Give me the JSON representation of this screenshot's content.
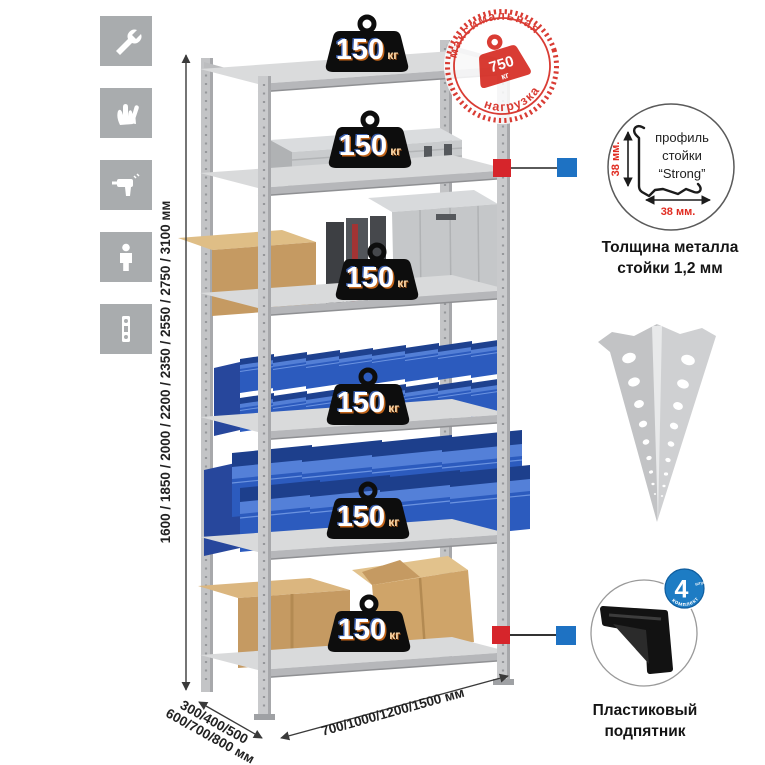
{
  "stamp": {
    "arc_top": "максимальная",
    "arc_bottom": "нагрузка",
    "weight": "750",
    "unit": "кг"
  },
  "shelf_badge": {
    "value": "150",
    "unit": "кг"
  },
  "dimensions": {
    "height": "1600 / 1850 / 2000 / 2200 / 2350 / 2550 / 2750 / 3100 мм",
    "depth_line1": "300/400/500",
    "depth_line2": "600/700/800 мм",
    "width": "700/1000/1200/1500 мм"
  },
  "profile_detail": {
    "label_line1": "профиль",
    "label_line2": "стойки",
    "label_line3": "“Strong”",
    "dim_vertical": "38 мм.",
    "dim_horizontal": "38 мм.",
    "caption_line1": "Толщина металла",
    "caption_line2": "стойки 1,2 мм"
  },
  "foot_detail": {
    "badge_value": "4",
    "badge_note": "штуки",
    "badge_arc": "в комплекте",
    "caption_line1": "Пластиковый",
    "caption_line2": "подпятник"
  },
  "icons": [
    {
      "name": "wrench-icon"
    },
    {
      "name": "gloves-icon"
    },
    {
      "name": "drill-icon"
    },
    {
      "name": "assembly-person-icon"
    },
    {
      "name": "perforated-post-icon"
    }
  ],
  "colors": {
    "stamp_red": "#d8352c",
    "marker_red": "#d6252b",
    "marker_blue": "#1e72c3",
    "bin_blue": "#2c5bbe",
    "metal_gray": "#c7c8ca",
    "icon_bg": "#a9acae",
    "badge_black": "#0d0d0d",
    "foot_badge_blue": "#1d7cc4"
  }
}
